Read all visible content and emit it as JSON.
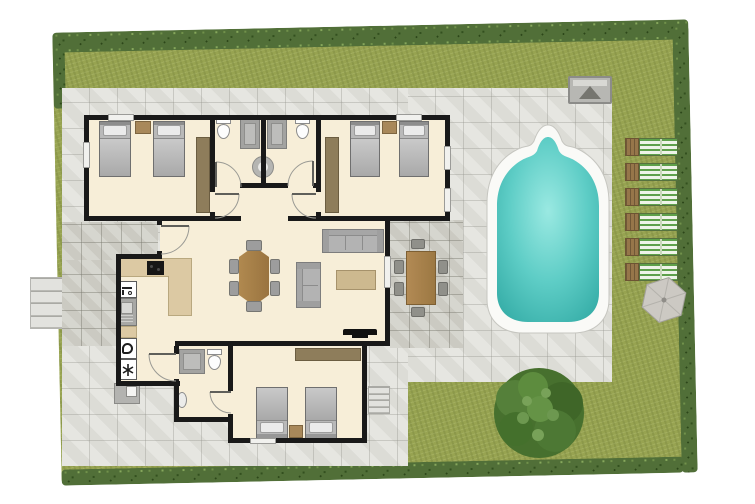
{
  "scene": {
    "kind": "top-down residential villa floor plan with garden and swimming pool",
    "canvas": {
      "width": 755,
      "height": 504
    }
  },
  "palette": {
    "lawn": "#97a351",
    "hedge": "#516f38",
    "paving": "#dcdcd6",
    "paving_dark": "#cbcac2",
    "floor": "#f7eed8",
    "wall": "#191919",
    "wood_table": "#a5804b",
    "counter": "#dcc9a3",
    "wardrobe": "#8e7d5b",
    "fabric_gray": "#b3b3b3",
    "pool_water": "#5ecdc6",
    "pool_coping": "#fafaf7",
    "lounger_stripe": "#5ea04b",
    "umbrella": "#ccc9c3",
    "tree": "#47702e"
  },
  "rooms": [
    {
      "id": "bedroom-1",
      "label": "twin bedroom north-west",
      "furniture": [
        "single bed",
        "single bed",
        "nightstand",
        "wardrobe"
      ]
    },
    {
      "id": "bathroom-1",
      "label": "bathroom west",
      "furniture": [
        "toilet",
        "shower",
        "round basin"
      ]
    },
    {
      "id": "bathroom-2",
      "label": "bathroom east",
      "furniture": [
        "toilet",
        "shower",
        "round basin"
      ]
    },
    {
      "id": "bedroom-2",
      "label": "twin bedroom north-east",
      "furniture": [
        "single bed",
        "single bed",
        "nightstand",
        "wardrobe"
      ]
    },
    {
      "id": "hallway",
      "label": "hallway",
      "furniture": []
    },
    {
      "id": "living-dining",
      "label": "open living and dining room",
      "furniture": [
        "dining table",
        "6 dining chairs",
        "3-seat sofa",
        "2-seat sofa",
        "coffee table",
        "tv"
      ]
    },
    {
      "id": "kitchen",
      "label": "kitchen and laundry",
      "furniture": [
        "L-shaped counter",
        "cooktop",
        "sink",
        "dishwasher",
        "washing machine",
        "freezer"
      ]
    },
    {
      "id": "bathroom-3",
      "label": "bathroom south",
      "furniture": [
        "shower",
        "toilet",
        "washbasin"
      ]
    },
    {
      "id": "bedroom-3",
      "label": "twin bedroom south",
      "furniture": [
        "single bed",
        "single bed",
        "nightstand",
        "wardrobe"
      ]
    }
  ],
  "outdoor": {
    "garden": {
      "lawn": true,
      "hedge_sides": [
        "top",
        "right",
        "bottom",
        "top-left corner"
      ]
    },
    "pool": {
      "shape": "rectangle with arched head",
      "water_color": "#5ecdc6"
    },
    "sun_loungers": {
      "count": 6,
      "stripe_color": "#5ea04b"
    },
    "parasol": {
      "shape": "hexagon",
      "count": 1
    },
    "tree": {
      "count": 1
    },
    "barbecue": {
      "present": true
    },
    "outdoor_dining": {
      "tables": 1,
      "chairs": 6
    },
    "outdoor_sink": {
      "present": true
    },
    "steps": {
      "west_entry_treads": 4,
      "east_terrace_treads": 4
    },
    "doors": {
      "swing_doors": 7,
      "patio_opening": 1
    },
    "windows": {
      "count": 7
    }
  }
}
